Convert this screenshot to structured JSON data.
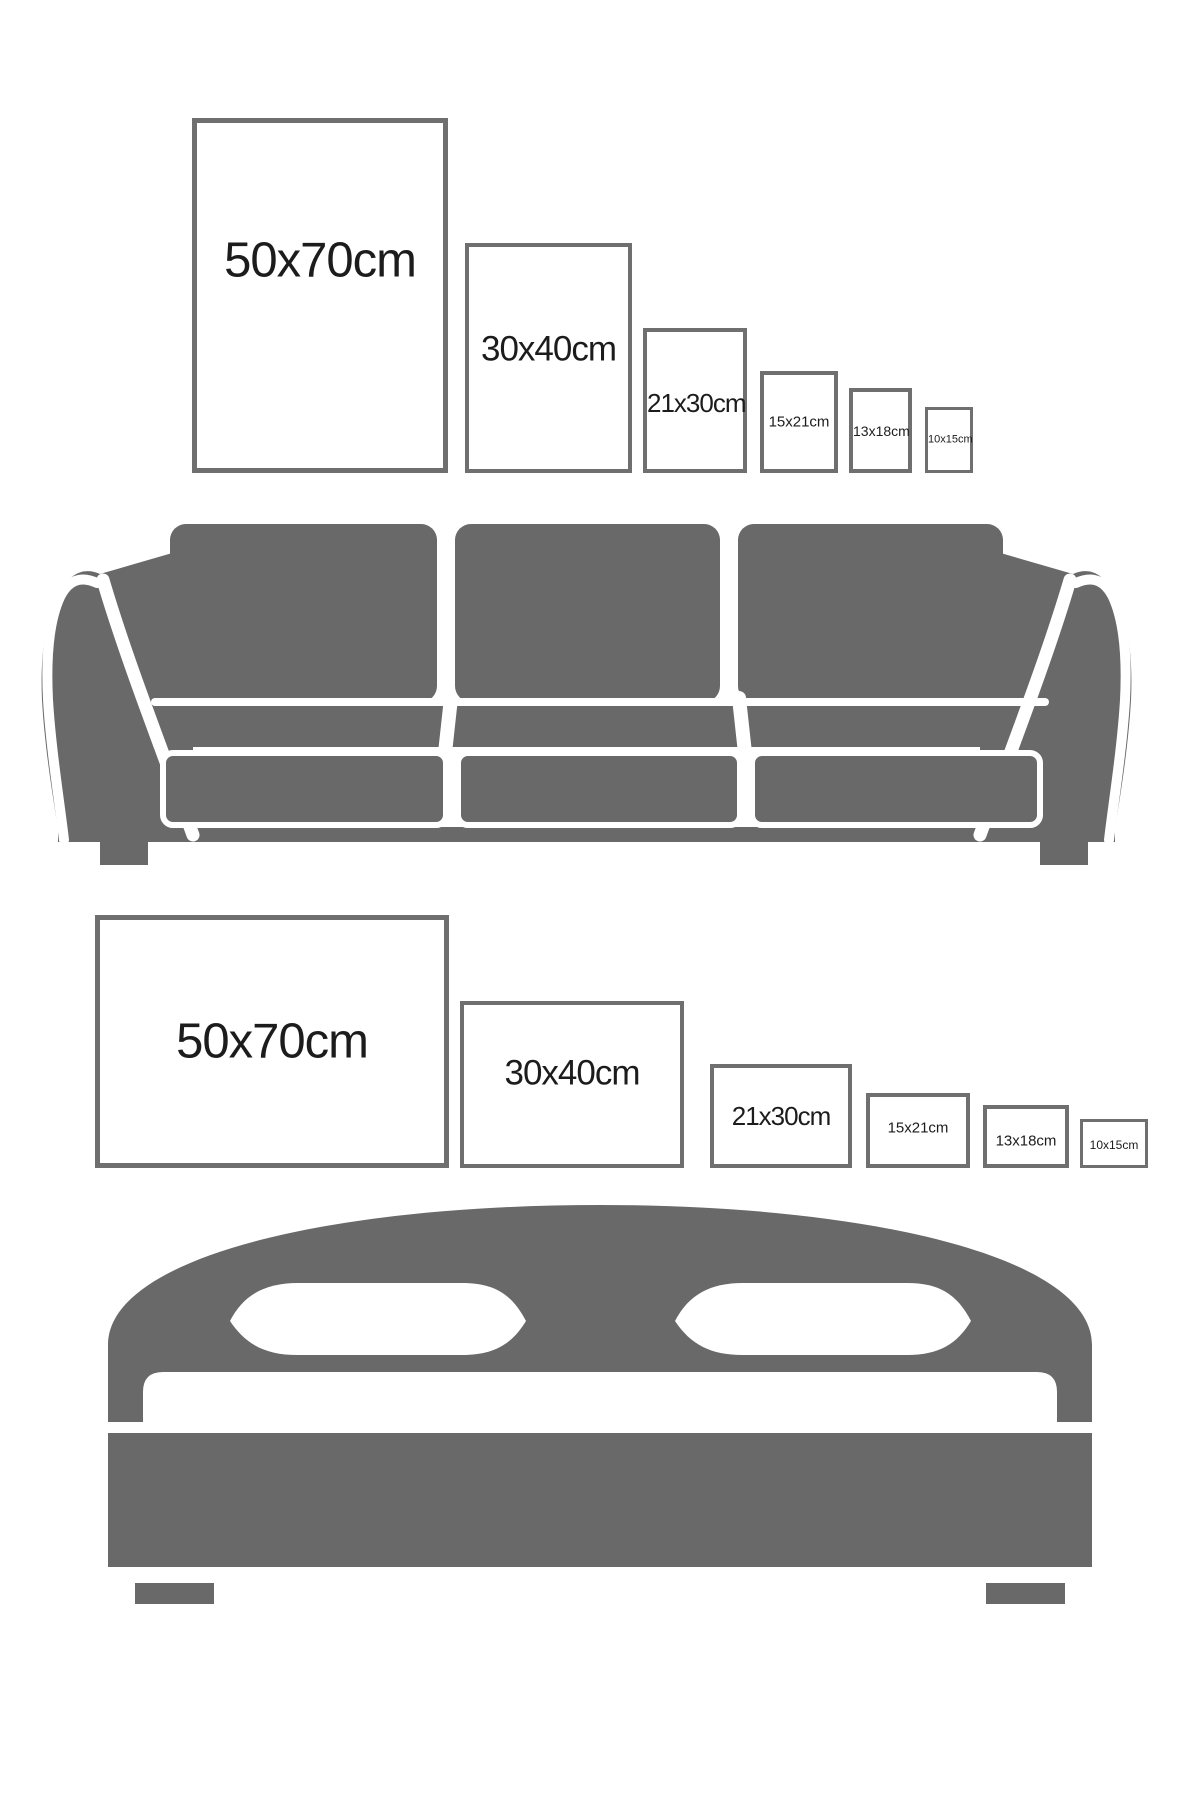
{
  "colors": {
    "background": "#ffffff",
    "furniture_gray": "#696969",
    "frame_border": "#6f6f6f",
    "label_color": "#1c1c1c"
  },
  "top_row": {
    "furniture_icon": "sofa-icon",
    "orientation": "portrait",
    "frames": [
      {
        "label": "50x70cm"
      },
      {
        "label": "30x40cm"
      },
      {
        "label": "21x30cm"
      },
      {
        "label": "15x21cm"
      },
      {
        "label": "13x18cm"
      },
      {
        "label": "10x15cm"
      }
    ]
  },
  "bottom_row": {
    "furniture_icon": "bed-icon",
    "orientation": "landscape",
    "frames": [
      {
        "label": "50x70cm"
      },
      {
        "label": "30x40cm"
      },
      {
        "label": "21x30cm"
      },
      {
        "label": "15x21cm"
      },
      {
        "label": "13x18cm"
      },
      {
        "label": "10x15cm"
      }
    ]
  }
}
